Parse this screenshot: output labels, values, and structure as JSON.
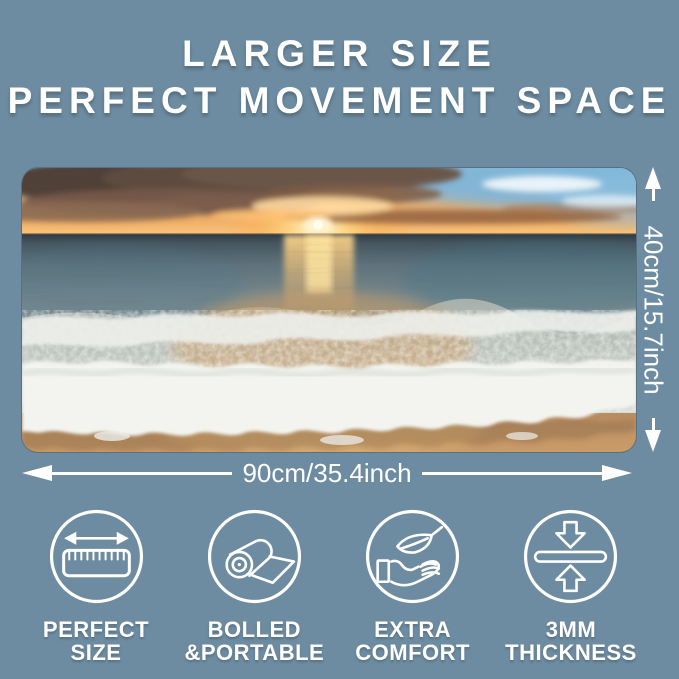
{
  "colors": {
    "background": "#6d8ca1",
    "text": "#ffffff"
  },
  "header": {
    "line1": "LARGER SIZE",
    "line2": "PERFECT MOVEMENT SPACE"
  },
  "product": {
    "scene": "ocean-sunset-beach-mousepad-photo"
  },
  "dimensions": {
    "width_label": "90cm/35.4inch",
    "height_label": "40cm/15.7inch"
  },
  "features": [
    {
      "icon": "ruler-width-icon",
      "line1": "PERFECT",
      "line2": "SIZE"
    },
    {
      "icon": "rolled-mat-icon",
      "line1": "BOLLED",
      "line2": "&PORTABLE"
    },
    {
      "icon": "hand-leaf-comfort-icon",
      "line1": "EXTRA",
      "line2": "COMFORT"
    },
    {
      "icon": "thickness-arrows-icon",
      "line1": "3MM",
      "line2": "THICKNESS"
    }
  ]
}
